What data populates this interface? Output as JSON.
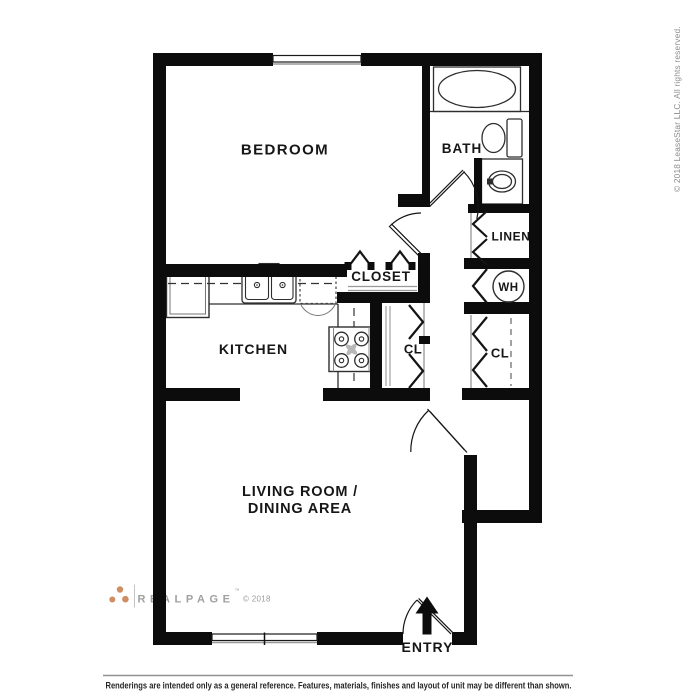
{
  "plan": {
    "rooms": {
      "bedroom": "BEDROOM",
      "bath": "BATH",
      "linen": "LINEN",
      "water_heater": "WH",
      "closet": "CLOSET",
      "closet_left": "CL",
      "closet_right": "CL",
      "kitchen": "KITCHEN",
      "living_line1": "LIVING ROOM /",
      "living_line2": "DINING AREA",
      "entry": "ENTRY"
    },
    "fixtures": [
      "bathtub-icon",
      "toilet-icon",
      "vanity-sink-icon",
      "refrigerator-icon",
      "kitchen-sink-icon",
      "dishwasher-icon",
      "stove-icon",
      "water-heater-icon"
    ]
  },
  "branding": {
    "logo_text": "REALPAGE",
    "logo_tm": "™",
    "logo_copyright": "© 2018",
    "logo_dot_color": "#cf8d62"
  },
  "legal": {
    "side_note": "© 2018 LeaseStar LLC. All rights reserved.",
    "disclaimer": "Renderings are intended only as a general reference. Features, materials, finishes and layout of unit may be different than shown."
  },
  "colors": {
    "wall": "#0c0c0c",
    "fixture_line": "#2e2e2e",
    "background": "#ffffff"
  }
}
